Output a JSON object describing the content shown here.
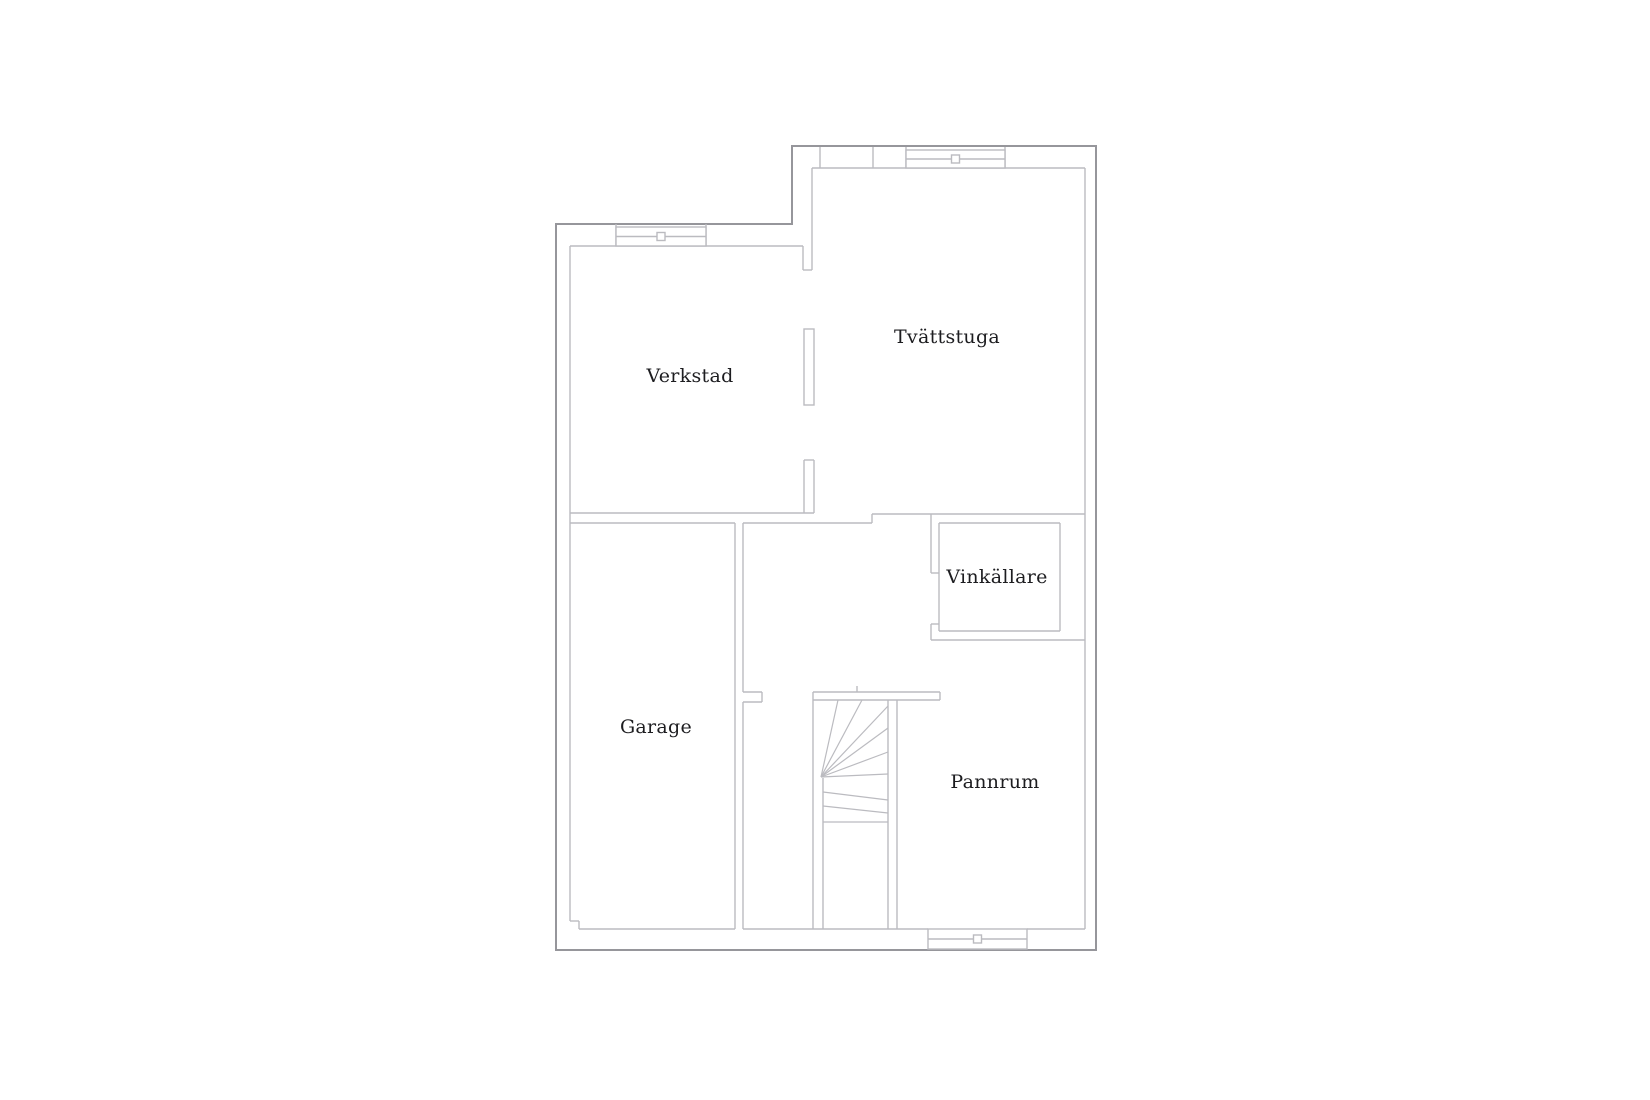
{
  "floor_plan": {
    "canvas": {
      "w": 1650,
      "h": 1100
    },
    "colors": {
      "background": "#ffffff",
      "exterior_wall": "#96969b",
      "interior_wall": "#bbbbc0",
      "label_text": "#1d1d20"
    },
    "rooms": [
      {
        "id": "verkstad",
        "label": "Verkstad",
        "cx": 690,
        "cy": 382
      },
      {
        "id": "tvattstuga",
        "label": "Tvättstuga",
        "cx": 947,
        "cy": 343
      },
      {
        "id": "vinkallare",
        "label": "Vinkällare",
        "cx": 997,
        "cy": 583
      },
      {
        "id": "garage",
        "label": "Garage",
        "cx": 656,
        "cy": 733
      },
      {
        "id": "pannrum",
        "label": "Pannrum",
        "cx": 995,
        "cy": 788
      }
    ],
    "exterior_outline": [
      [
        556,
        224
      ],
      [
        792,
        224
      ],
      [
        792,
        146
      ],
      [
        1096,
        146
      ],
      [
        1096,
        950
      ],
      [
        556,
        950
      ]
    ],
    "interior_segments": [
      [
        570,
        246,
        803,
        246
      ],
      [
        570,
        246,
        570,
        921
      ],
      [
        570,
        513,
        814,
        513
      ],
      [
        803,
        246,
        803,
        270
      ],
      [
        812,
        168,
        812,
        270
      ],
      [
        803,
        270,
        812,
        270
      ],
      [
        820,
        147,
        820,
        168
      ],
      [
        812,
        168,
        1085,
        168
      ],
      [
        804,
        460,
        804,
        513
      ],
      [
        814,
        460,
        814,
        513
      ],
      [
        804,
        460,
        814,
        460
      ],
      [
        1085,
        168,
        1085,
        929
      ],
      [
        872,
        514,
        1085,
        514
      ],
      [
        872,
        514,
        872,
        523
      ],
      [
        814,
        523,
        872,
        523
      ],
      [
        570,
        523,
        735,
        523
      ],
      [
        743,
        523,
        814,
        523
      ],
      [
        735,
        523,
        735,
        929
      ],
      [
        743,
        523,
        743,
        692
      ],
      [
        743,
        702,
        743,
        929
      ],
      [
        743,
        692,
        762,
        692
      ],
      [
        743,
        702,
        762,
        702
      ],
      [
        762,
        692,
        762,
        702
      ],
      [
        570,
        921,
        579,
        921
      ],
      [
        579,
        921,
        579,
        929
      ],
      [
        579,
        929,
        735,
        929
      ],
      [
        743,
        929,
        813,
        929
      ],
      [
        813,
        929,
        897,
        929
      ],
      [
        897,
        929,
        928,
        929
      ],
      [
        1027,
        929,
        1085,
        929
      ],
      [
        813,
        692,
        813,
        929
      ],
      [
        823,
        778,
        823,
        929
      ],
      [
        888,
        700,
        888,
        929
      ],
      [
        897,
        700,
        897,
        929
      ],
      [
        813,
        692,
        940,
        692
      ],
      [
        813,
        700,
        940,
        700
      ],
      [
        940,
        692,
        940,
        700
      ],
      [
        857,
        686,
        857,
        692
      ],
      [
        931,
        514,
        931,
        573
      ],
      [
        931,
        573,
        939,
        573
      ],
      [
        939,
        523,
        1060,
        523
      ],
      [
        939,
        523,
        939,
        631
      ],
      [
        1060,
        523,
        1060,
        631
      ],
      [
        939,
        631,
        1060,
        631
      ],
      [
        931,
        640,
        1085,
        640
      ],
      [
        931,
        624,
        931,
        640
      ],
      [
        931,
        624,
        939,
        624
      ],
      [
        873,
        147,
        873,
        168
      ],
      [
        906,
        147,
        906,
        168
      ],
      [
        1005,
        147,
        1005,
        168
      ],
      [
        616,
        224,
        616,
        246
      ],
      [
        706,
        224,
        706,
        246
      ]
    ],
    "wall_stub_rects": [
      [
        804,
        329,
        10,
        76
      ]
    ],
    "windows": [
      {
        "id": "window-verkstad-top",
        "x": 616,
        "y": 227,
        "w": 90,
        "h": 19
      },
      {
        "id": "window-tvattstuga-top",
        "x": 906,
        "y": 150,
        "w": 99,
        "h": 18
      },
      {
        "id": "window-pannrum-bottom",
        "x": 928,
        "y": 929,
        "w": 99,
        "h": 20
      }
    ],
    "stair_treads": [
      [
        821,
        777,
        838,
        700
      ],
      [
        821,
        777,
        862,
        700
      ],
      [
        821,
        777,
        888,
        706
      ],
      [
        821,
        777,
        888,
        728
      ],
      [
        821,
        777,
        888,
        752
      ],
      [
        821,
        777,
        888,
        774
      ],
      [
        823,
        792,
        888,
        800
      ],
      [
        823,
        806,
        888,
        813
      ],
      [
        823,
        822,
        888,
        822
      ]
    ]
  }
}
